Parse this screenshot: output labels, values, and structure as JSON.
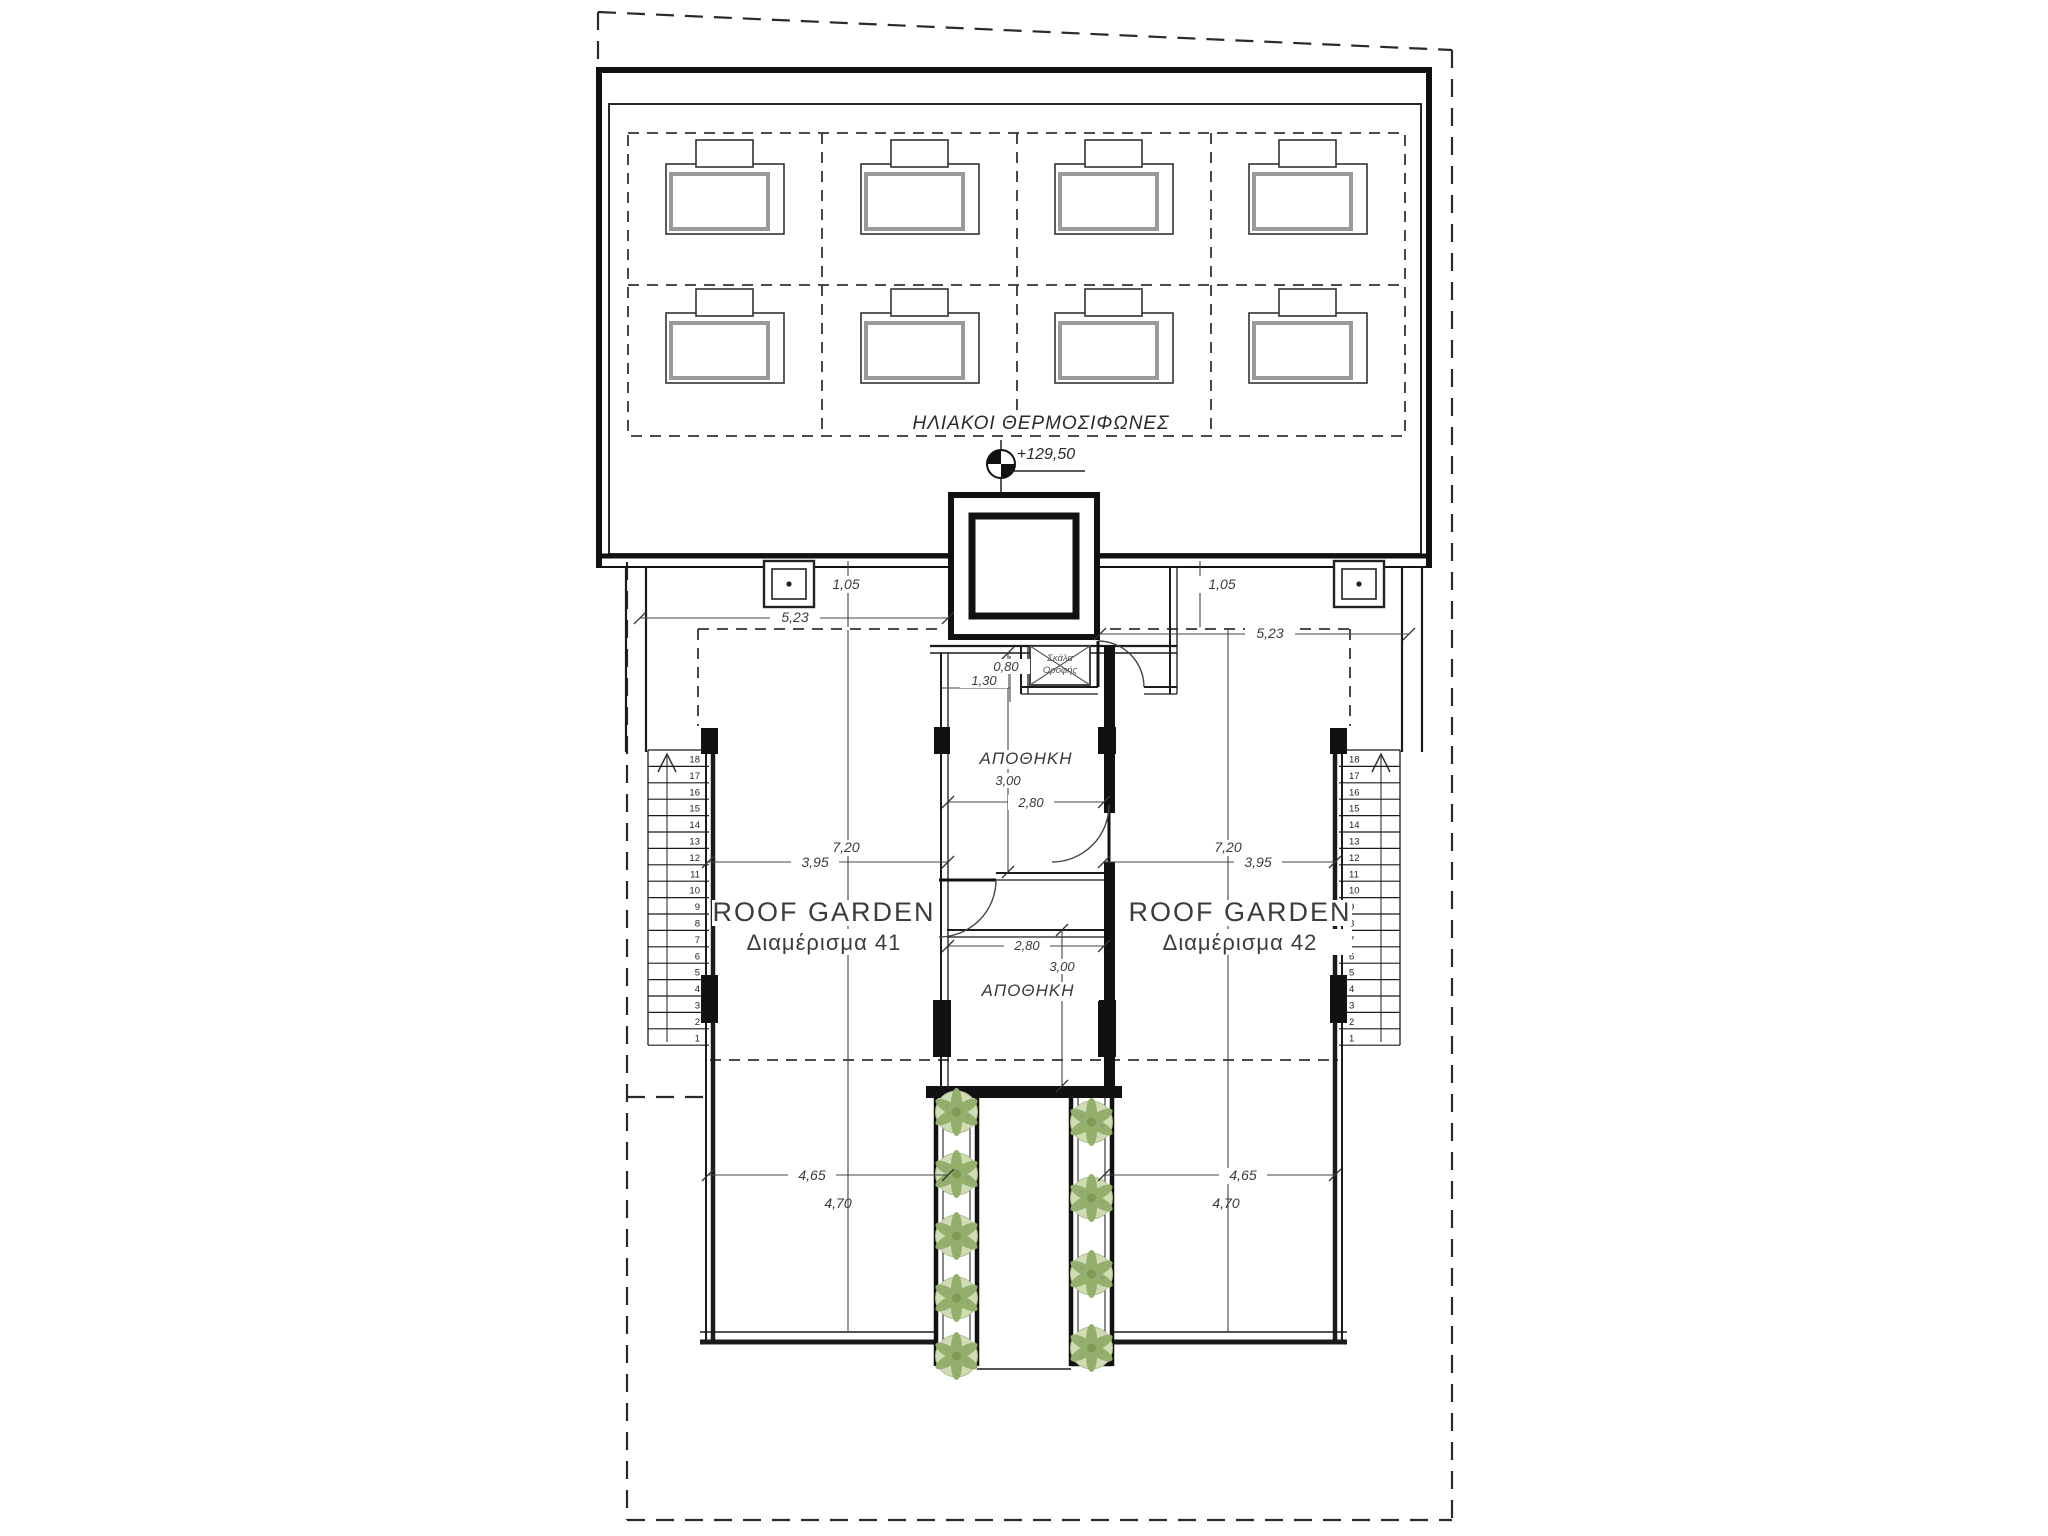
{
  "labels": {
    "solar_heaters": "ΗΛΙΑΚΟΙ ΘΕΡΜΟΣΙΦΩΝΕΣ",
    "elevation_level": "+129,50",
    "roof_ladder_line1": "Σκάλα",
    "roof_ladder_line2": "Οροφής",
    "storage_upper": "ΑΠΟΘΗΚΗ",
    "storage_lower": "ΑΠΟΘΗΚΗ",
    "roof_garden_left_title": "ROOF GARDEN",
    "roof_garden_left_subtitle": "Διαμέρισμα 41",
    "roof_garden_right_title": "ROOF GARDEN",
    "roof_garden_right_subtitle": "Διαμέρισμα 42"
  },
  "dimensions": {
    "parapet_offset_left": "1,05",
    "parapet_offset_right": "1,05",
    "parapet_width_left": "5,23",
    "parapet_width_right": "5,23",
    "garden_depth_left": "7,20",
    "garden_depth_right": "7,20",
    "garden_split_left": "3,95",
    "garden_split_right": "3,95",
    "garden_width_left": "4,65",
    "garden_width_right": "4,65",
    "garden_width2_left": "4,70",
    "garden_width2_right": "4,70",
    "storage_upper_width": "2,80",
    "storage_upper_depth": "3,00",
    "storage_lower_width": "2,80",
    "storage_lower_depth": "3,00",
    "hatch_width": "0,80",
    "hatch_offset": "1,30"
  },
  "stairs": {
    "tread_count": 18,
    "top_number": 18,
    "bottom_number": 1
  },
  "solar_units": {
    "rows": 2,
    "columns": 4,
    "total": 8
  },
  "planters": {
    "left_plant_count": 5,
    "right_plant_count": 4
  },
  "colors": {
    "plant_fill": "#cfdcb4",
    "plant_leaf": "#94ae6b",
    "plant_core": "#7d9a55",
    "line": "#1b1b1b",
    "dim_text": "#3a3a3a"
  }
}
